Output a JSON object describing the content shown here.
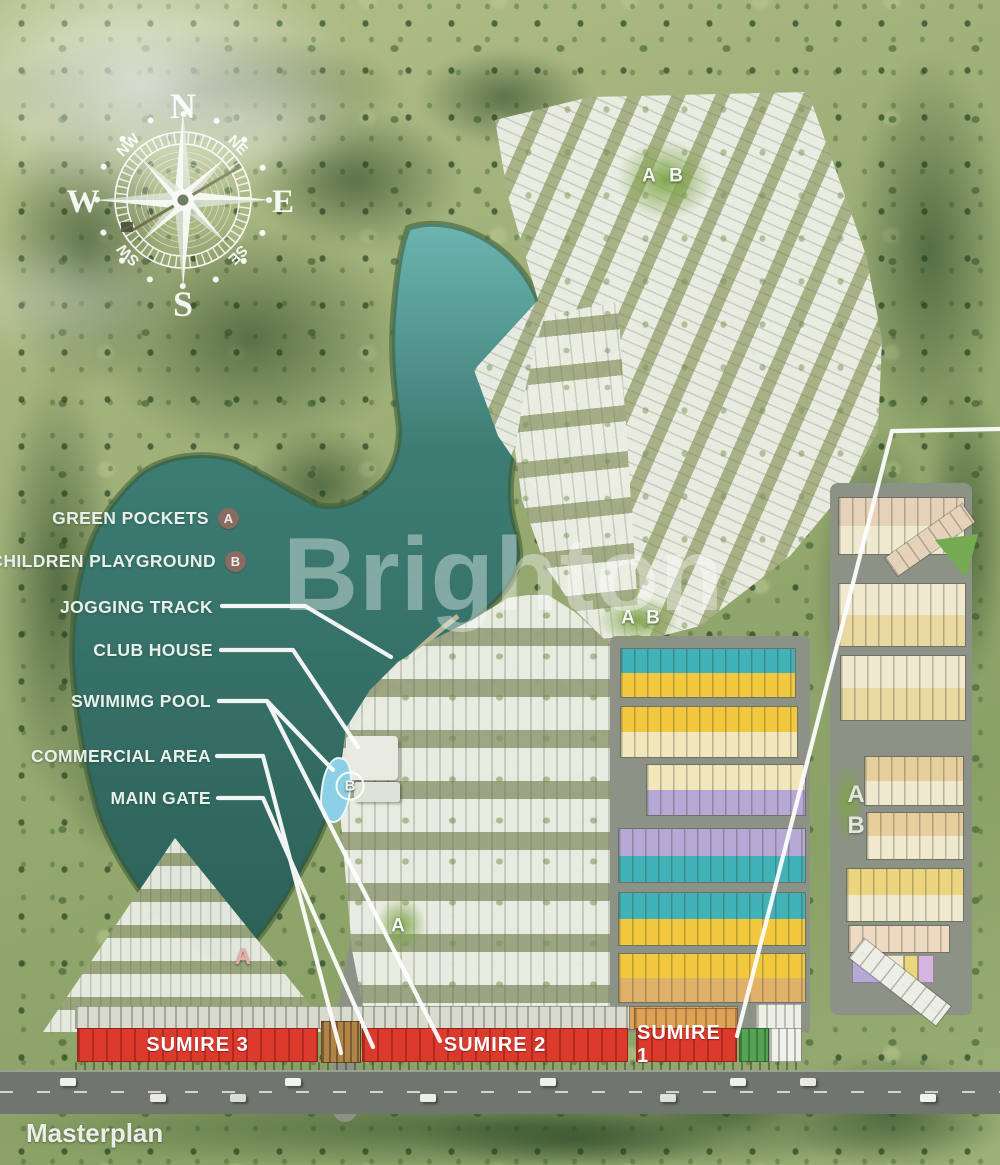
{
  "page": {
    "title_label": "Masterplan",
    "watermark": "Brighton"
  },
  "compass": {
    "cardinals": [
      "N",
      "E",
      "S",
      "W"
    ],
    "intercardinals": [
      "NW",
      "NE",
      "SW",
      "SE"
    ]
  },
  "legend": {
    "items": [
      {
        "label": "GREEN POCKETS",
        "badge": "A"
      },
      {
        "label": "CHILDREN PLAYGROUND",
        "badge": "B"
      },
      {
        "label": "JOGGING TRACK"
      },
      {
        "label": "CLUB HOUSE"
      },
      {
        "label": "SWIMIMG POOL"
      },
      {
        "label": "COMMERCIAL AREA"
      },
      {
        "label": "MAIN GATE"
      }
    ]
  },
  "banners": [
    {
      "label": "SUMIRE 3",
      "x": 77,
      "y": 1028,
      "w": 241
    },
    {
      "label": "SUMIRE 2",
      "x": 362,
      "y": 1028,
      "w": 266
    },
    {
      "label": "SUMIRE 1",
      "x": 636,
      "y": 1028,
      "w": 101
    }
  ],
  "map_markers": [
    {
      "label": "A",
      "x": 649,
      "y": 176,
      "kind": "plain"
    },
    {
      "label": "B",
      "x": 676,
      "y": 176,
      "kind": "plain"
    },
    {
      "label": "A",
      "x": 628,
      "y": 618,
      "kind": "plain"
    },
    {
      "label": "B",
      "x": 653,
      "y": 618,
      "kind": "plain"
    },
    {
      "label": "B",
      "x": 350,
      "y": 786,
      "kind": "ring"
    },
    {
      "label": "A",
      "x": 398,
      "y": 926,
      "kind": "plain"
    },
    {
      "label": "A",
      "x": 243,
      "y": 957,
      "kind": "pink"
    },
    {
      "label": "A",
      "x": 856,
      "y": 795,
      "kind": "big"
    },
    {
      "label": "B",
      "x": 856,
      "y": 826,
      "kind": "big"
    }
  ],
  "colors": {
    "lake_dark": "#2e6a62",
    "lake_mid": "#3d7d74",
    "lake_light": "#68b3ad",
    "teal": "#41b2b8",
    "yellow": "#f2c93e",
    "cream": "#f2e7bb",
    "purple": "#b7a9d6",
    "tan": "#e0b269",
    "orange": "#dfa254",
    "red": "#dd3a2e",
    "green_block": "#55a453",
    "white_house": "#edefe7",
    "road": "#8d9286",
    "badge": "#8a6b5f",
    "gate": "#b08448",
    "pinktan": "#e6d2b8",
    "cream2": "#f0e9cf",
    "paleyellow": "#e9d8a0",
    "tanlight": "#e7cf9d",
    "yellow2": "#ecd57f",
    "pinkcream": "#eed9c2",
    "lilac": "#d5b5dd"
  }
}
